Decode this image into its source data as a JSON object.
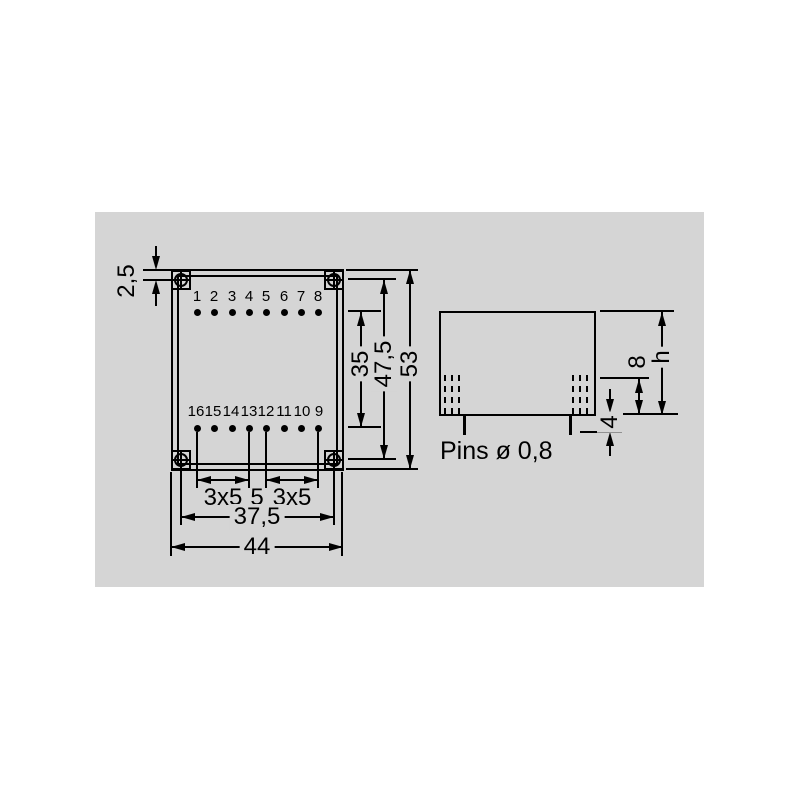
{
  "top_view": {
    "pins_top": [
      "1",
      "2",
      "3",
      "4",
      "5",
      "6",
      "7",
      "8"
    ],
    "pins_bottom": [
      "16",
      "15",
      "14",
      "13",
      "12",
      "11",
      "10",
      "9"
    ],
    "dim_hole_edge_offset": "2,5",
    "dim_pin_row_span": "35",
    "dim_hole_span_vertical": "47,5",
    "dim_body_height": "53",
    "dim_pin_group_left": "3x5",
    "dim_center_pitch": "5",
    "dim_pin_group_right": "3x5",
    "dim_hole_span_horizontal": "37,5",
    "dim_body_width": "44"
  },
  "side_view": {
    "dim_pin_seat_depth": "8",
    "dim_case_height": "h",
    "dim_pin_protrusion": "4",
    "pins_note": "Pins ø 0,8"
  },
  "colors": {
    "page_background": "#ffffff",
    "panel_background": "#d5d5d5",
    "line": "#000000"
  }
}
